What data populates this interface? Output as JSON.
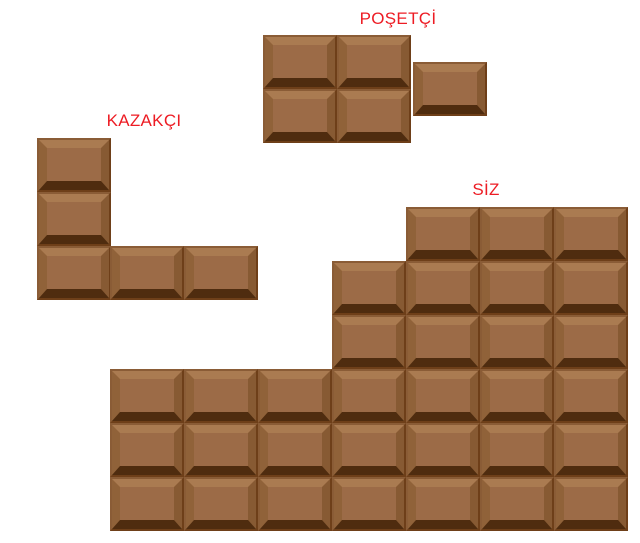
{
  "colors": {
    "page-bg": "#ffffff",
    "label-color": "#ED1C24",
    "choc-face": "#9c6b47",
    "choc-bevel-top": "#aa7b51",
    "choc-bevel-left": "#906239",
    "choc-bevel-right": "#875a33",
    "choc-bevel-bottom": "#4f2c0f",
    "choc-edge": "#7c4e26",
    "choc-edge-light": "#8a5c36",
    "choc-edge-dark": "#6e3f19"
  },
  "groups": [
    {
      "id": "posetci",
      "label": "POŞETÇİ",
      "piece_count": 5,
      "piece_w": 74,
      "piece_h": 54,
      "pieces": [
        [
          263,
          35
        ],
        [
          337,
          35
        ],
        [
          263,
          89
        ],
        [
          337,
          89
        ],
        [
          413,
          62
        ]
      ]
    },
    {
      "id": "kazakci",
      "label": "KAZAKÇI",
      "piece_count": 5,
      "piece_w": 74,
      "piece_h": 54,
      "pieces": [
        [
          37,
          138
        ],
        [
          37,
          192
        ],
        [
          37,
          246
        ],
        [
          110,
          246
        ],
        [
          184,
          246
        ]
      ]
    },
    {
      "id": "siz",
      "label": "SİZ",
      "piece_count": 32,
      "piece_w": 74,
      "piece_h": 54,
      "pieces": [
        [
          406,
          207
        ],
        [
          480,
          207
        ],
        [
          554,
          207
        ],
        [
          332,
          261
        ],
        [
          406,
          261
        ],
        [
          480,
          261
        ],
        [
          554,
          261
        ],
        [
          332,
          315
        ],
        [
          406,
          315
        ],
        [
          480,
          315
        ],
        [
          554,
          315
        ],
        [
          110,
          369
        ],
        [
          184,
          369
        ],
        [
          258,
          369
        ],
        [
          332,
          369
        ],
        [
          406,
          369
        ],
        [
          480,
          369
        ],
        [
          554,
          369
        ],
        [
          110,
          423
        ],
        [
          184,
          423
        ],
        [
          258,
          423
        ],
        [
          332,
          423
        ],
        [
          406,
          423
        ],
        [
          480,
          423
        ],
        [
          554,
          423
        ],
        [
          110,
          477
        ],
        [
          184,
          477
        ],
        [
          258,
          477
        ],
        [
          332,
          477
        ],
        [
          406,
          477
        ],
        [
          480,
          477
        ],
        [
          554,
          477
        ]
      ]
    }
  ]
}
